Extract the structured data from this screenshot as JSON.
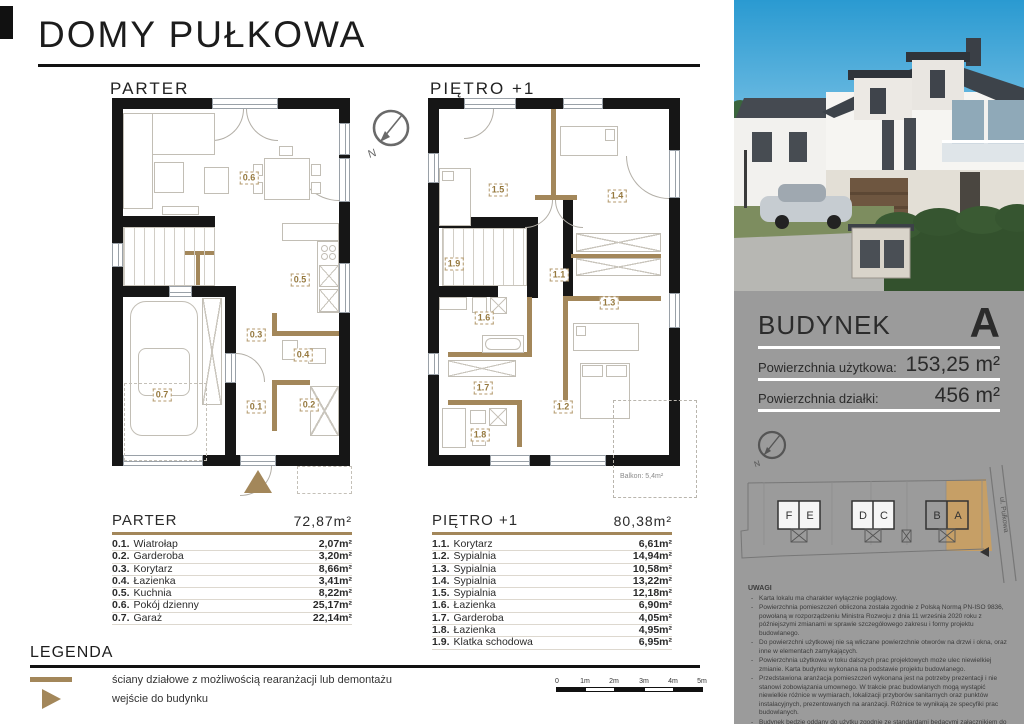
{
  "header": {
    "title": "DOMY PUŁKOWA"
  },
  "floor_plans": {
    "compass_label": "N",
    "parter": {
      "label": "PARTER",
      "rooms": [
        "0.1",
        "0.2",
        "0.3",
        "0.4",
        "0.5",
        "0.6",
        "0.7"
      ]
    },
    "pietro": {
      "label": "PIĘTRO +1",
      "rooms": [
        "1.1",
        "1.2",
        "1.3",
        "1.4",
        "1.5",
        "1.6",
        "1.7",
        "1.8",
        "1.9"
      ],
      "balcony_label": "Balkon: 5,4m²"
    }
  },
  "room_tables": [
    {
      "title": "PARTER",
      "total": "72,87m²",
      "rows": [
        {
          "num": "0.1.",
          "name": "Wiatrołap",
          "area": "2,07m²"
        },
        {
          "num": "0.2.",
          "name": "Garderoba",
          "area": "3,20m²"
        },
        {
          "num": "0.3.",
          "name": "Korytarz",
          "area": "8,66m²"
        },
        {
          "num": "0.4.",
          "name": "Łazienka",
          "area": "3,41m²"
        },
        {
          "num": "0.5.",
          "name": "Kuchnia",
          "area": "8,22m²"
        },
        {
          "num": "0.6.",
          "name": "Pokój dzienny",
          "area": "25,17m²"
        },
        {
          "num": "0.7.",
          "name": "Garaż",
          "area": "22,14m²"
        }
      ]
    },
    {
      "title": "PIĘTRO +1",
      "total": "80,38m²",
      "rows": [
        {
          "num": "1.1.",
          "name": "Korytarz",
          "area": "6,61m²"
        },
        {
          "num": "1.2.",
          "name": "Sypialnia",
          "area": "14,94m²"
        },
        {
          "num": "1.3.",
          "name": "Sypialnia",
          "area": "10,58m²"
        },
        {
          "num": "1.4.",
          "name": "Sypialnia",
          "area": "13,22m²"
        },
        {
          "num": "1.5.",
          "name": "Sypialnia",
          "area": "12,18m²"
        },
        {
          "num": "1.6.",
          "name": "Łazienka",
          "area": "6,90m²"
        },
        {
          "num": "1.7.",
          "name": "Garderoba",
          "area": "4,05m²"
        },
        {
          "num": "1.8.",
          "name": "Łazienka",
          "area": "4,95m²"
        },
        {
          "num": "1.9.",
          "name": "Klatka schodowa",
          "area": "6,95m²"
        }
      ]
    }
  ],
  "legend": {
    "title": "LEGENDA",
    "items": [
      {
        "icon": "partition-wall-line",
        "label": "ściany działowe z możliwością rearanżacji lub demontażu"
      },
      {
        "icon": "entrance-triangle",
        "label": "wejście do budynku"
      }
    ]
  },
  "scale_bar": {
    "ticks": [
      "0",
      "1m",
      "2m",
      "3m",
      "4m",
      "5m"
    ]
  },
  "building_panel": {
    "name_label": "BUDYNEK",
    "building_letter": "A",
    "rows": [
      {
        "label": "Powierzchnia użytkowa:",
        "value": "153,25 m²"
      },
      {
        "label": "Powierzchnia działki:",
        "value": "456 m²"
      }
    ],
    "site_plan": {
      "street": "ul. Pułkowa",
      "buildings": [
        "F",
        "E",
        "D",
        "C",
        "B",
        "A"
      ],
      "highlighted": "A"
    },
    "notes": {
      "title": "UWAGI",
      "items": [
        "Karta lokalu ma charakter wyłącznie poglądowy.",
        "Powierzchnia pomieszczeń obliczona została zgodnie z Polską Normą PN-ISO 9836, powołaną w rozporządzeniu Ministra Rozwoju z dnia 11 września 2020 roku z późniejszymi zmianami w sprawie szczegółowego zakresu i formy projektu budowlanego.",
        "Do powierzchni użytkowej nie są wliczane powierzchnie otworów na drzwi i okna, oraz inne w elementach zamykających.",
        "Powierzchnia użytkowa w toku dalszych prac projektowych może ulec niewielkiej zmianie. Karta budynku wykonana na podstawie projektu budowlanego.",
        "Przedstawiona aranżacja pomieszczeń wykonana jest na potrzeby prezentacji i nie stanowi zobowiązania umownego. W trakcie prac budowlanych mogą wystąpić niewielkie różnice w wymiarach, lokalizacji przyborów sanitarnych oraz punktów instalacyjnych, prezentowanych na aranżacji. Różnice te wynikają ze specyfiki prac budowlanych.",
        "Budynek będzie oddany do użytku zgodnie ze standardami będącymi załącznikiem do umowy deweloperskiej.",
        "Naruszanie elementów konstrukcyjnych jest zabronione."
      ]
    }
  },
  "colors": {
    "accent_tan": "#a3875a",
    "site_highlight": "#c69f66",
    "panel_gray": "#9b9b9b",
    "wall": "#161616"
  }
}
